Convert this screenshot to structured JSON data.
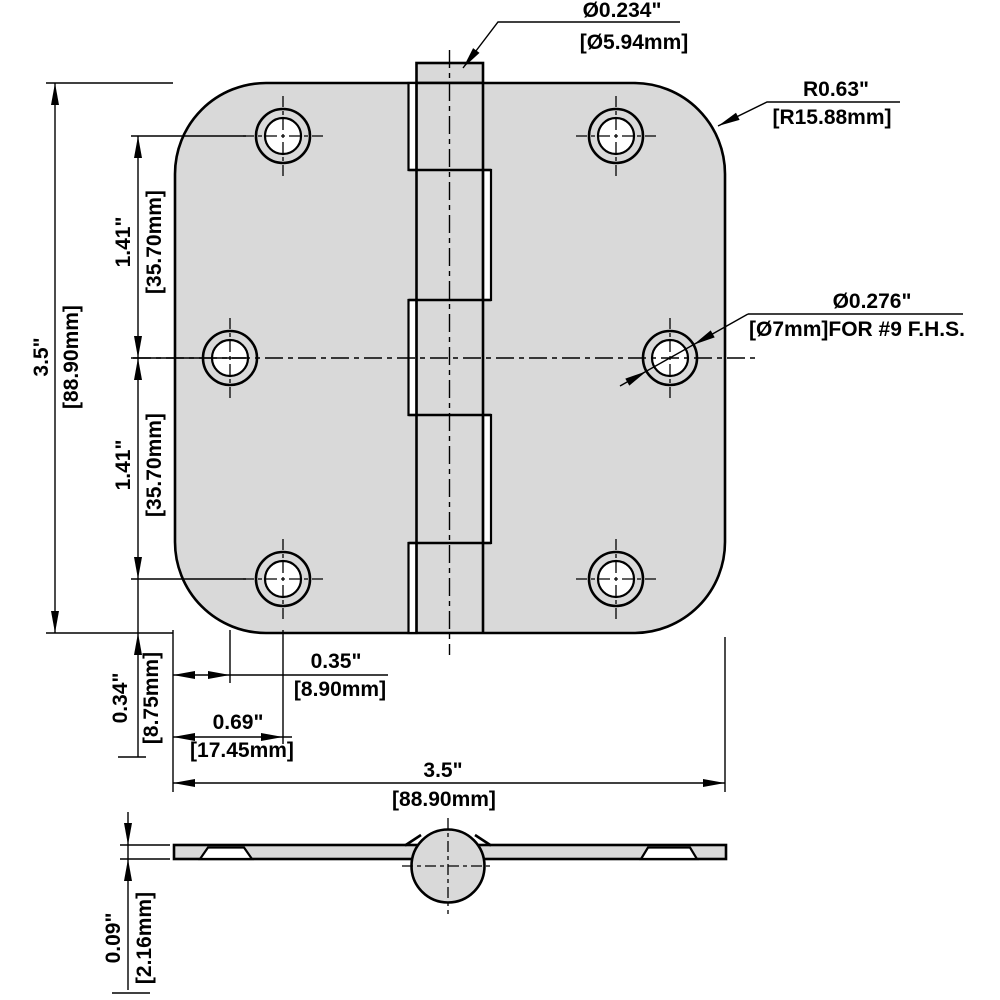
{
  "colors": {
    "body_fill": "#d9d9d9",
    "line": "#000000",
    "background": "#ffffff"
  },
  "dimensions": {
    "pin_diameter": {
      "inches": "Ø0.234\"",
      "mm": "[Ø5.94mm]"
    },
    "corner_radius": {
      "inches": "R0.63\"",
      "mm": "[R15.88mm]"
    },
    "screw_hole": {
      "inches": "Ø0.276\"",
      "mm": "[Ø7mm]FOR #9 F.H.S."
    },
    "overall_height": {
      "inches": "3.5\"",
      "mm": "[88.90mm]"
    },
    "hole_spacing_upper": {
      "inches": "1.41\"",
      "mm": "[35.70mm]"
    },
    "hole_spacing_lower": {
      "inches": "1.41\"",
      "mm": "[35.70mm]"
    },
    "bottom_hole_to_edge": {
      "inches": "0.34\"",
      "mm": "[8.75mm]"
    },
    "edge_to_middle_hole": {
      "inches": "0.35\"",
      "mm": "[8.90mm]"
    },
    "edge_to_outer_holes": {
      "inches": "0.69\"",
      "mm": "[17.45mm]"
    },
    "overall_width": {
      "inches": "3.5\"",
      "mm": "[88.90mm]"
    },
    "leaf_thickness": {
      "inches": "0.09\"",
      "mm": "[2.16mm]"
    }
  }
}
